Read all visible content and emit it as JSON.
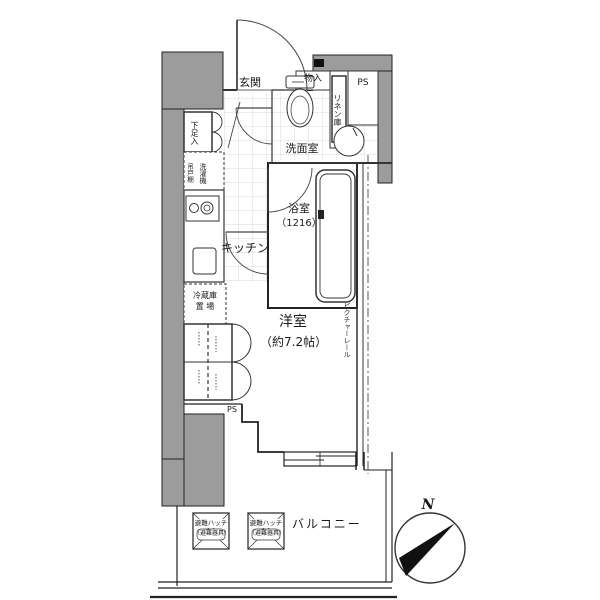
{
  "floorplan": {
    "entrance": {
      "label": "玄関"
    },
    "hall_storage": {
      "label": "物入"
    },
    "linen_closet": {
      "label": "リネン庫"
    },
    "pipe_space_upper": {
      "label": "PS"
    },
    "shoe_cabinet": {
      "label": "下足入"
    },
    "washroom": {
      "label": "洗面室"
    },
    "laundry": {
      "upper_cabinet": "吊戸棚",
      "washer": "洗濯機"
    },
    "kitchen": {
      "label": "キッチン"
    },
    "fridge_space": {
      "line1": "冷蔵庫",
      "line2": "置 場"
    },
    "bathroom": {
      "name": "浴室",
      "size": "（1216）"
    },
    "main_room": {
      "name": "洋室",
      "size": "（約7.2帖）"
    },
    "picture_rail": {
      "label": "ピクチャーレール"
    },
    "pipe_space_lower": {
      "label": "PS"
    },
    "balcony": {
      "label": "バルコニー"
    },
    "hatches": [
      {
        "label": "避難ハッチ",
        "sub": "（避難器具）"
      },
      {
        "label": "避難ハッチ",
        "sub": "（避難器具）"
      }
    ],
    "compass": {
      "north": "N"
    },
    "colors": {
      "wall_fill": "#9c9c9c",
      "line": "#222222"
    }
  }
}
